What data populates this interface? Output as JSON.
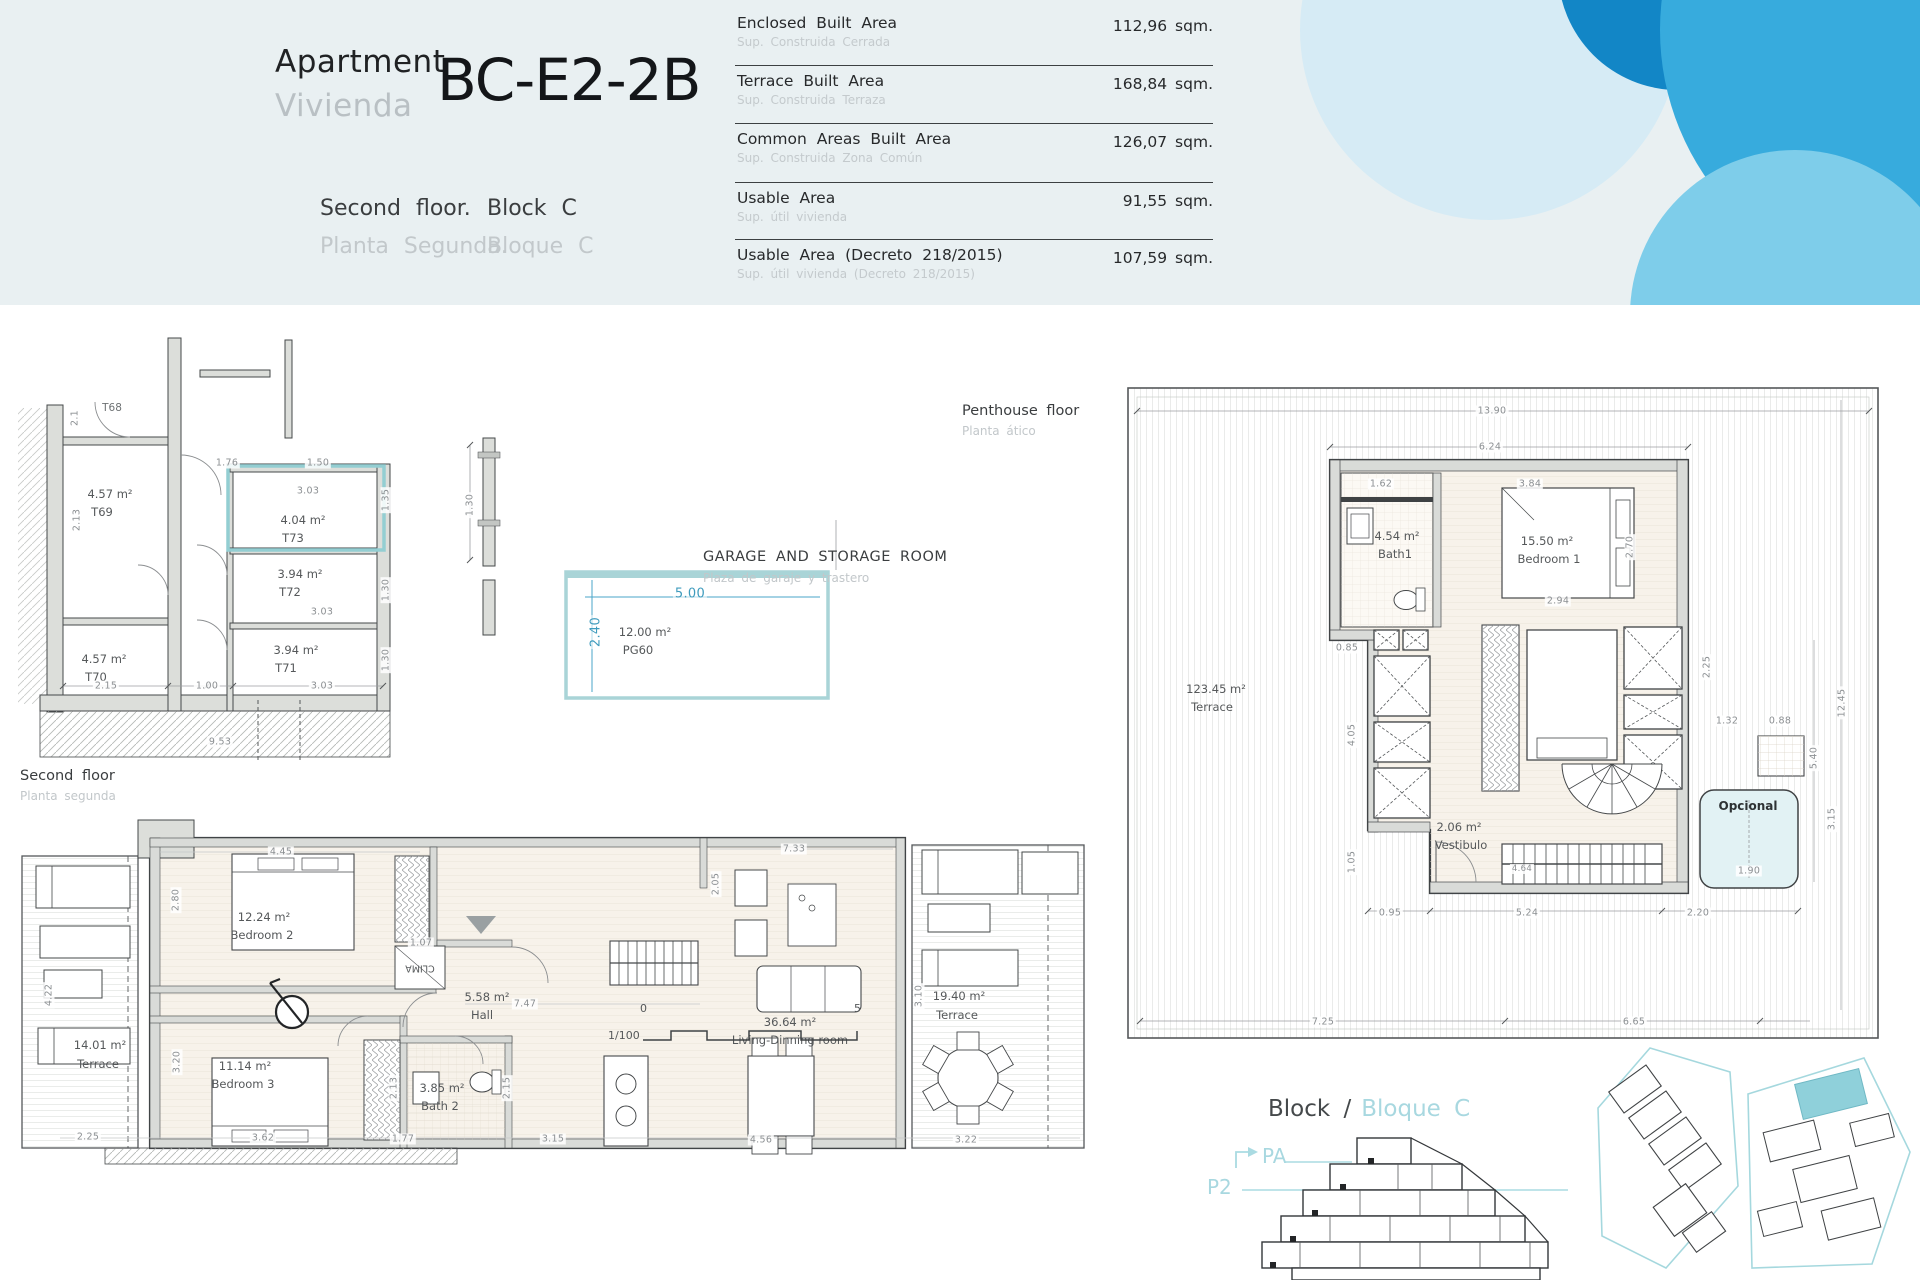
{
  "header": {
    "apartment_en": "Apartment",
    "apartment_es": "Vivienda",
    "unit_code": "BC-E2-2B",
    "floor_en": "Second floor.",
    "floor_es": "Planta Segunda.",
    "block_en": "Block C",
    "block_es": "Bloque C",
    "areas": [
      {
        "label_en": "Enclosed Built Area",
        "label_es": "Sup. Construida Cerrada",
        "value": "112,96 sqm."
      },
      {
        "label_en": "Terrace Built Area",
        "label_es": "Sup. Construida Terraza",
        "value": "168,84 sqm."
      },
      {
        "label_en": "Common Areas Built Area",
        "label_es": "Sup. Construida Zona Común",
        "value": "126,07 sqm."
      },
      {
        "label_en": "Usable Area",
        "label_es": "Sup. útil vivienda",
        "value": "91,55 sqm."
      },
      {
        "label_en": "Usable Area (Decreto 218/2015)",
        "label_es": "Sup. útil vivienda (Decreto 218/2015)",
        "value": "107,59 sqm."
      }
    ]
  },
  "labels": {
    "penthouse_en": "Penthouse floor",
    "penthouse_es": "Planta ático",
    "garage_en": "GARAGE AND STORAGE ROOM",
    "garage_es": "Plaza de garaje y trastero",
    "second_en": "Second floor",
    "second_es": "Planta segunda",
    "block_title_en": "Block /",
    "block_title_es": "Bloque C",
    "pa": "PA",
    "p2": "P2",
    "scale": "1/100",
    "scale_start": "0",
    "scale_end": "5"
  },
  "storage": {
    "t68": "T68",
    "rooms": [
      {
        "area": "4.57 m²",
        "id": "T69"
      },
      {
        "area": "4.04 m²",
        "id": "T73"
      },
      {
        "area": "3.94 m²",
        "id": "T72"
      },
      {
        "area": "3.94 m²",
        "id": "T71"
      },
      {
        "area": "4.57 m²",
        "id": "T70"
      }
    ],
    "dims": [
      "2.1",
      "1.76",
      "1.50",
      "3.03",
      "2.13",
      "1.35",
      "3.03",
      "1.30",
      "3.03",
      "1.30",
      "2.15",
      "1.00",
      "9.53"
    ]
  },
  "garage": {
    "area": "12.00 m²",
    "id": "PG60",
    "w": "5.00",
    "h": "2.40",
    "side": "1.30"
  },
  "penthouse": {
    "terrace_area": "123.45 m²",
    "terrace": "Terrace",
    "bath_area": "4.54 m²",
    "bath": "Bath1",
    "bed_area": "15.50 m²",
    "bed": "Bedroom 1",
    "vest_area": "2.06 m²",
    "vest": "Vestibulo",
    "optional": "Opcional",
    "dims": [
      "13.90",
      "6.24",
      "1.62",
      "3.84",
      "2.94",
      "2.70",
      "0.85",
      "4.05",
      "1.05",
      "0.95",
      "5.24",
      "2.20",
      "4.64",
      "7.25",
      "6.65",
      "2.25",
      "1.32",
      "0.88",
      "5.40",
      "12.45",
      "3.15",
      "1.90"
    ]
  },
  "second": {
    "terrace_l_area": "14.01 m²",
    "terrace_l": "Terrace",
    "bed2_area": "12.24 m²",
    "bed2": "Bedroom 2",
    "bed3_area": "11.14 m²",
    "bed3": "Bedroom 3",
    "bath2_area": "3.85 m²",
    "bath2": "Bath 2",
    "hall_area": "5.58 m²",
    "hall": "Hall",
    "living_area": "36.64 m²",
    "living": "Living-Dinning room",
    "terrace_r_area": "19.40 m²",
    "terrace_r": "Terrace",
    "clima": "CLIMA",
    "dims": [
      "4.45",
      "2.80",
      "4.22",
      "3.20",
      "2.25",
      "3.62",
      "1.77",
      "3.15",
      "4.56",
      "3.22",
      "7.47",
      "7.33",
      "2.05",
      "3.10",
      "2.15",
      "2.13",
      "1.07"
    ]
  }
}
